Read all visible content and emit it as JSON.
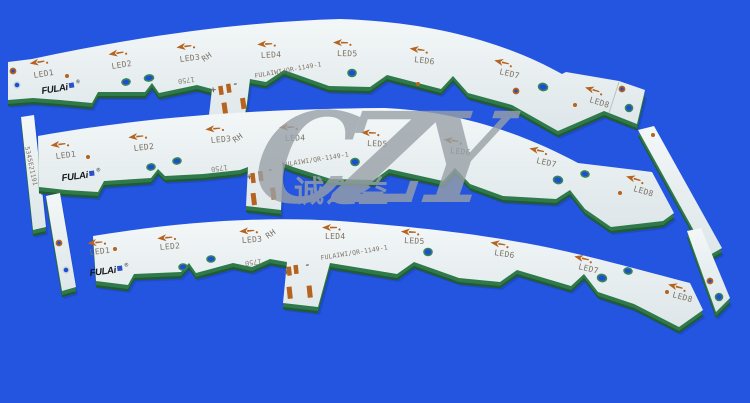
{
  "image": {
    "background_color": "#2355e1",
    "description": "Three white arc-shaped aluminum LED PCB strips on a blue background"
  },
  "watermark": {
    "brand": "CZY",
    "registered": "®",
    "chinese": "诚之益",
    "color": "#99a1a8"
  },
  "pcb": {
    "brand": "FULAi",
    "brand_registered": "®",
    "led_labels": [
      "LED1",
      "LED2",
      "LED3",
      "LED4",
      "LED5",
      "LED6",
      "LED7",
      "LED8"
    ],
    "marking_rh": "RH",
    "marking_1750": "1750",
    "part_number": "FULAIWI/QR-1149-1",
    "serial_number": "5345E21191",
    "polarity_plus": "+",
    "polarity_minus": "-",
    "colors": {
      "board_surface": "#e9eff1",
      "edge_green": "#2f7a4b",
      "copper": "#b5631e",
      "silkscreen": "#7b7264"
    }
  }
}
